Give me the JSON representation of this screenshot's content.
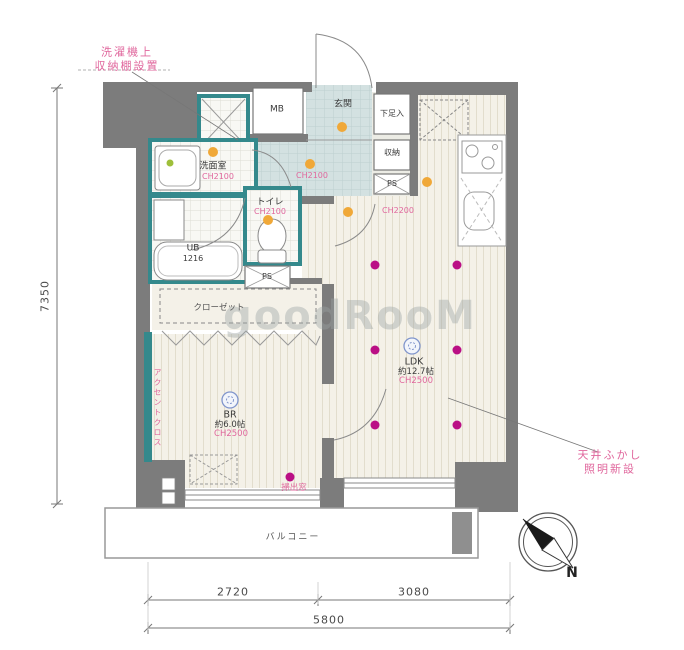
{
  "annotations": {
    "washer_note": {
      "line1": "洗濯機上",
      "line2": "収納棚設置"
    },
    "ceiling_note": {
      "line1": "天井ふかし",
      "line2": "照明新設"
    },
    "accent_wall": "アクセントクロス",
    "window_note": "掃出窓"
  },
  "rooms": {
    "washroom": {
      "name": "洗面室",
      "ch": "CH2100"
    },
    "toilet": {
      "name": "トイレ",
      "ch": "CH2100"
    },
    "bath": {
      "name": "UB",
      "size": "1216"
    },
    "meter_box": "MB",
    "entrance": "玄関",
    "shoe_cabinet": "下足入",
    "storage": "収納",
    "pipe_space_upper": "PS",
    "pipe_space_lower": "PS",
    "hall_ch": "CH2100",
    "kitchen_ch": "CH2200",
    "closet": "クローゼット",
    "bedroom": {
      "name": "BR",
      "size": "約6.0帖",
      "ch": "CH2500"
    },
    "ldk": {
      "name": "LDK",
      "size": "約12.7帖",
      "ch": "CH2500"
    },
    "balcony": "バルコニー"
  },
  "dimensions": {
    "height_total": "7350",
    "width_left": "2720",
    "width_right": "3080",
    "width_total": "5800"
  },
  "compass": {
    "label": "N"
  },
  "watermark": "goodRooM",
  "colors": {
    "wall": "#7c7c7c",
    "wet_area_wall": "#34898c",
    "new_downlight": "#ba0f85",
    "existing_light": "#f0a838",
    "annotation_pink": "#e0679d"
  }
}
